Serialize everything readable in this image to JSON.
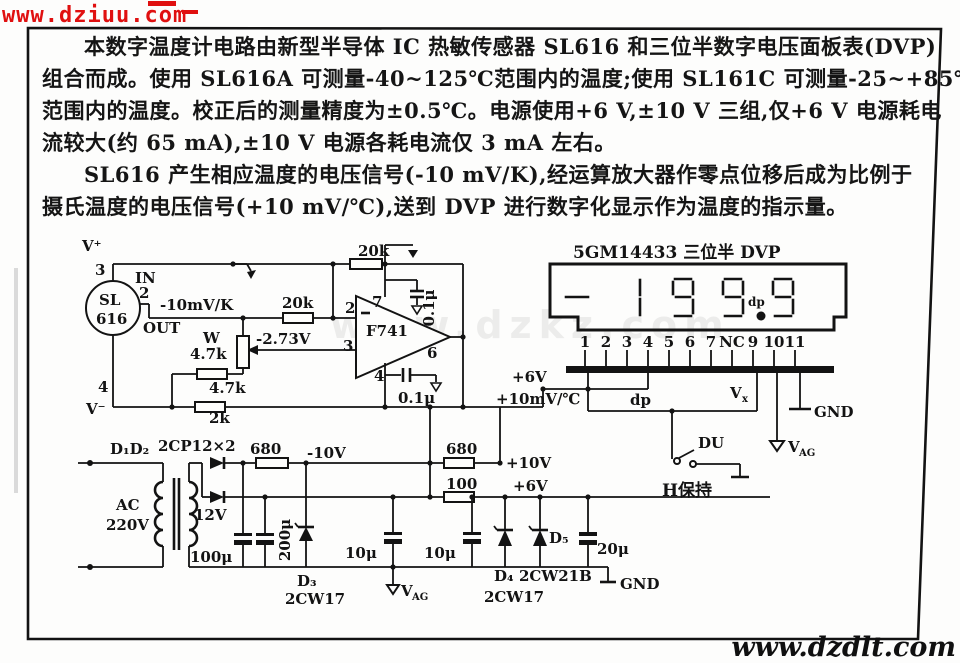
{
  "watermarks": {
    "top": "www.dziuu.com",
    "bottom": "www.dzdlt.com",
    "ghost": "www.dzkz.com"
  },
  "colors": {
    "watermark_red": "#e01010",
    "ink": "#131313"
  },
  "description": {
    "lines": [
      "本数字温度计电路由新型半导体 IC 热敏传感器 SL616 和三位半数字电压面板表(DVP)",
      "组合而成。使用 SL616A 可测量-40~125℃范围内的温度;使用 SL161C 可测量-25~+85℃",
      "范围内的温度。校正后的测量精度为±0.5℃。电源使用+6 V,±10 V 三组,仅+6 V 电源耗电",
      "流较大(约 65 mA),±10 V 电源各耗电流仅 3 mA 左右。",
      "SL616 产生相应温度的电压信号(-10 mV/K),经运算放大器作零点位移后成为比例于",
      "摄氏温度的电压信号(+10 mV/℃),送到 DVP 进行数字化显示作为温度的指示量。"
    ]
  },
  "schematic": {
    "labels": {
      "v_plus": "V⁺",
      "pin3": "3",
      "in_label": "IN",
      "pin2": "2",
      "sl_line1": "SL",
      "sl_line2": "616",
      "out_label": "OUT",
      "temp_coeff": "-10mV/K",
      "pin4": "4",
      "v_minus": "V⁻",
      "pot_name": "W",
      "pot_value": "4.7k",
      "r_47k": "4.7k",
      "r_2k": "2k",
      "r_20k_in": "20k",
      "offset_v": "-2.73V",
      "r_20k_fb": "20k",
      "opamp": "F741",
      "op_pin2": "2",
      "op_pin3": "3",
      "op_pin7": "7",
      "op_pin6": "6",
      "op_pin4": "4",
      "cap_01_top": "0.1μ",
      "cap_01_bot": "0.1μ",
      "dvp_title": "5GM14433 三位半 DVP",
      "disp_dp": "dp",
      "pin_labels": [
        "1",
        "2",
        "3",
        "4",
        "5",
        "6",
        "7",
        "NC",
        "9",
        "10",
        "11"
      ],
      "supply_6v": "+6V",
      "signal_10mv": "+10mV/℃",
      "dp_wire": "dp",
      "vx_main": "V",
      "vx_sub": "x",
      "gnd_dvp": "GND",
      "du": "DU",
      "hold": "H保持",
      "vag_main": "V",
      "vag_sub": "AG",
      "d1d2": "D₁D₂",
      "rectifier": "2CP12×2",
      "r_680a": "680",
      "rail_neg10": "-10V",
      "ac_line1": "AC",
      "ac_line2": "220V",
      "v_12": "12V",
      "cap_100u": "100μ",
      "cap_200u": "200μ",
      "d3_name": "D₃",
      "d3_type": "2CW17",
      "cap_10u_a": "10μ",
      "cap_10u_b": "10μ",
      "r_680b": "680",
      "rail_pos10": "+10V",
      "r_100": "100",
      "rail_pos6": "+6V",
      "d5_name": "D₅",
      "cap_20u": "20μ",
      "d4_name": "D₄",
      "d4_type": "2CW17",
      "d5_type": "2CW21B",
      "gnd_psu": "GND"
    }
  }
}
